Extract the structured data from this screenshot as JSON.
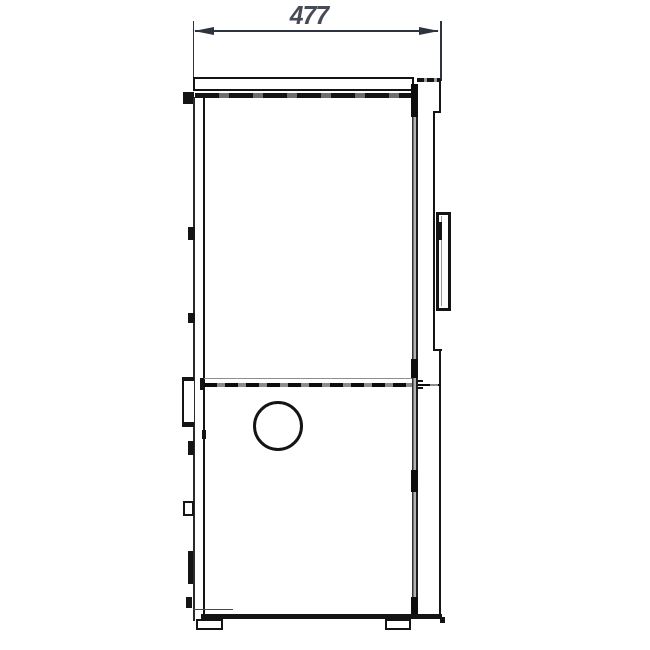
{
  "diagram": {
    "type": "technical-drawing",
    "subject": "appliance-side-view",
    "dimension": {
      "label": "477"
    },
    "colors": {
      "background": "#ffffff",
      "ink": "#141414",
      "dim": "#2e3340",
      "text": "#474b55"
    }
  }
}
